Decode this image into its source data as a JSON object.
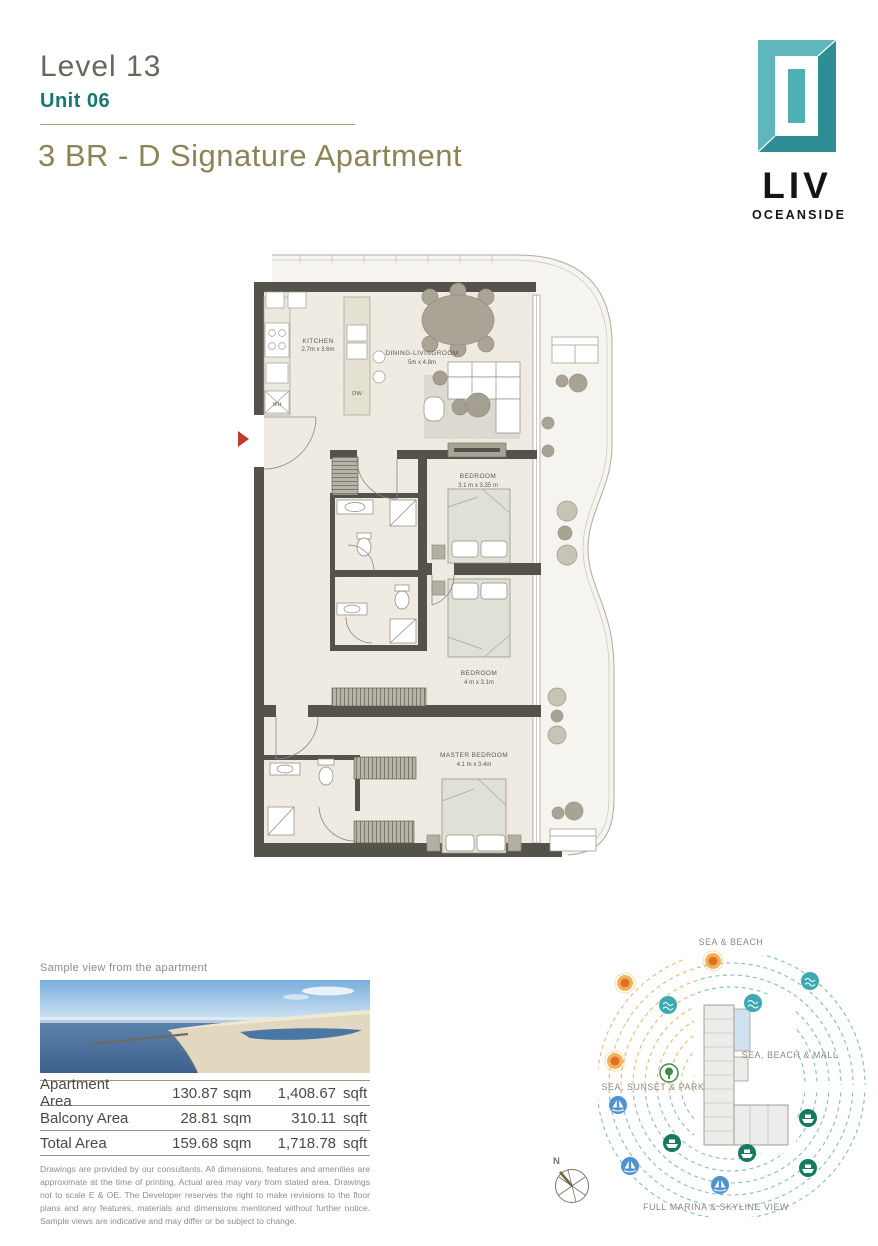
{
  "header": {
    "level": "Level 13",
    "unit": "Unit 06",
    "title": "3 BR - D Signature Apartment"
  },
  "logo": {
    "brand": "LIV",
    "subtitle": "OCEANSIDE"
  },
  "floorplan": {
    "rooms": [
      {
        "name": "KITCHEN",
        "dims": "2.7m x 3.6m"
      },
      {
        "name": "DINING-LIVINGROOM",
        "dims": "5m x 4.8m"
      },
      {
        "name": "BEDROOM",
        "dims": "3.1 m x 3.35 m"
      },
      {
        "name": "BEDROOM",
        "dims": "4 m x 3.1m"
      },
      {
        "name": "MASTER BEDROOM",
        "dims": "4.1 m x 3.4m"
      }
    ],
    "appliances": {
      "dishwasher": "DW",
      "water_heater": "WH"
    }
  },
  "sample_view": {
    "caption": "Sample view from the apartment"
  },
  "area_table": {
    "rows": [
      {
        "label": "Apartment Area",
        "sqm": "130.87",
        "sqm_unit": "sqm",
        "sqft": "1,408.67",
        "sqft_unit": "sqft"
      },
      {
        "label": "Balcony Area",
        "sqm": "28.81",
        "sqm_unit": "sqm",
        "sqft": "310.11",
        "sqft_unit": "sqft"
      },
      {
        "label": "Total Area",
        "sqm": "159.68",
        "sqm_unit": "sqm",
        "sqft": "1,718.78",
        "sqft_unit": "sqft"
      }
    ]
  },
  "disclaimer": "Drawings are provided by our consultants. All dimensions, features and amenities are approximate at the time of printing. Actual area may vary from stated area. Drawings not to scale E & OE. The Developer reserves the right to make revisions to the floor plans and any features, materials and dimensions mentioned without further notice. Sample views are indicative and may differ or be subject to change.",
  "compass": {
    "north": "N"
  },
  "site_map": {
    "labels": {
      "top": "SEA & BEACH",
      "right": "SEA, BEACH & MALL",
      "left": "SEA, SUNSET & PARK",
      "bottom": "FULL MARINA & SKYLINE VIEW"
    }
  },
  "colors": {
    "accent_teal": "#16796d",
    "title_olive": "#8c8356",
    "logo_teal_light": "#5fb7bd",
    "logo_teal_dark": "#2f8d95",
    "wall_dark": "#55524b",
    "arrow_red": "#c23b2a",
    "map_orange": "#e8a64f",
    "map_teal": "#45aab4",
    "map_green": "#157a60",
    "map_blue": "#4f93d3"
  }
}
